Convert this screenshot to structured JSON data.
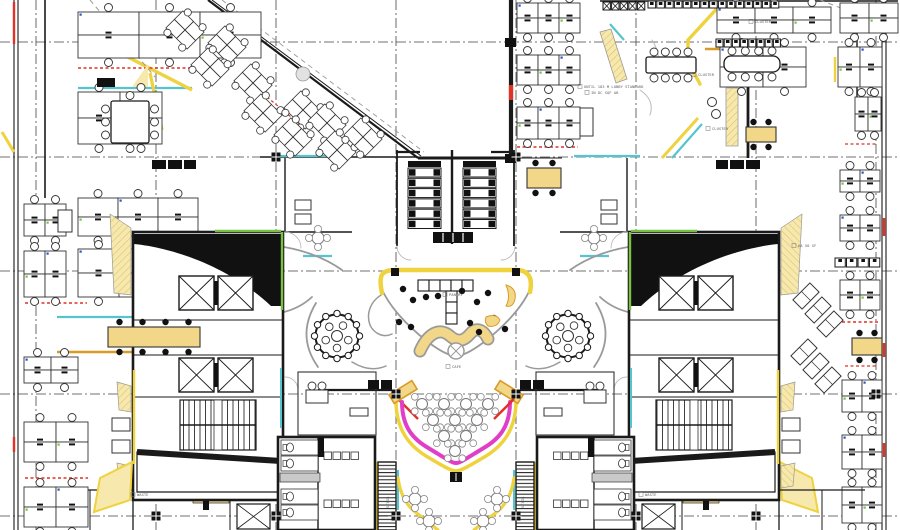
{
  "document": {
    "type": "architectural-floor-plan",
    "description": "office floor plan with two cores, central pantry atrium and cafe"
  },
  "palette": {
    "ink": "#1a1a1a",
    "line": "#333333",
    "gray": "#9a9a9a",
    "lgray": "#bbbbbb",
    "yellow": "#eed23e",
    "paleYellow": "#f7e8ad",
    "tan": "#f2d788",
    "gold": "#d99b26",
    "teal": "#56c4cf",
    "green": "#79c143",
    "magenta": "#e13ec8",
    "red": "#e03226",
    "blue": "#2b53c4"
  },
  "grid": {
    "v": [
      36,
      156,
      276,
      396,
      516,
      636,
      756,
      876
    ],
    "h": [
      42,
      157,
      271,
      394,
      516
    ],
    "markers": [
      [
        276,
        157
      ],
      [
        516,
        157
      ],
      [
        396,
        394
      ],
      [
        516,
        394
      ],
      [
        156,
        516
      ],
      [
        276,
        516
      ],
      [
        396,
        516
      ],
      [
        516,
        516
      ],
      [
        636,
        516
      ],
      [
        756,
        516
      ],
      [
        876,
        394
      ]
    ]
  },
  "annotations": [
    {
      "x": 584,
      "y": 88,
      "text": "UNTIL 183 M LOBBY STANDARD",
      "r": 0
    },
    {
      "x": 591,
      "y": 94,
      "text": "IN DC SQF AB",
      "r": 0
    },
    {
      "x": 755,
      "y": 23,
      "text": "CLUSTER",
      "r": 0
    },
    {
      "x": 698,
      "y": 76,
      "text": "CLUSTER",
      "r": 0
    },
    {
      "x": 712,
      "y": 130,
      "text": "CLUSTER",
      "r": 0
    },
    {
      "x": 449,
      "y": 296,
      "text": "PANTRY",
      "r": 0
    },
    {
      "x": 452,
      "y": 368,
      "text": "CAFE",
      "r": 0
    },
    {
      "x": 137,
      "y": 496,
      "text": "WASTE",
      "r": 0
    },
    {
      "x": 645,
      "y": 496,
      "text": "WASTE",
      "r": 0
    },
    {
      "x": 798,
      "y": 247,
      "text": "6A 50 SF",
      "r": 0
    },
    {
      "x": 389,
      "y": 508,
      "text": "STAIR",
      "r": -90
    },
    {
      "x": 524,
      "y": 508,
      "text": "STAIR",
      "r": -90
    }
  ],
  "clusters": [
    [
      78,
      12,
      3,
      2,
      61,
      23
    ],
    [
      78,
      92,
      2,
      2,
      42,
      26
    ],
    [
      78,
      198,
      3,
      2,
      40,
      19
    ],
    [
      78,
      249,
      3,
      2,
      41,
      24
    ],
    [
      24,
      204,
      2,
      2,
      21,
      16
    ],
    [
      24,
      251,
      2,
      2,
      21,
      23
    ],
    [
      24,
      357,
      2,
      2,
      27,
      13
    ],
    [
      24,
      422,
      2,
      2,
      32,
      20
    ],
    [
      24,
      487,
      2,
      2,
      32,
      20
    ],
    [
      517,
      3,
      3,
      2,
      21,
      15
    ],
    [
      517,
      55,
      3,
      2,
      21,
      15
    ],
    [
      517,
      107,
      3,
      2,
      21,
      16
    ],
    [
      717,
      7,
      3,
      2,
      38,
      13
    ],
    [
      840,
      3,
      2,
      2,
      29,
      15
    ],
    [
      838,
      47,
      2,
      2,
      22,
      20
    ],
    [
      720,
      47,
      2,
      2,
      43,
      20
    ],
    [
      855,
      97,
      2,
      2,
      13,
      17
    ],
    [
      840,
      170,
      2,
      2,
      20,
      11
    ],
    [
      840,
      215,
      2,
      2,
      20,
      13
    ],
    [
      840,
      280,
      2,
      2,
      20,
      15
    ],
    [
      842,
      380,
      2,
      2,
      20,
      16
    ],
    [
      842,
      435,
      2,
      2,
      20,
      17
    ],
    [
      842,
      487,
      2,
      2,
      20,
      18
    ]
  ],
  "cabinets": [
    [
      58,
      210,
      14,
      22
    ],
    [
      580,
      108,
      13,
      28
    ]
  ],
  "rot_clusters": {
    "deg": 45,
    "cw": 15,
    "ch": 12,
    "centers": [
      [
        185,
        30
      ],
      [
        227,
        45
      ],
      [
        210,
        67
      ],
      [
        253,
        83
      ],
      [
        263,
        113
      ],
      [
        303,
        110
      ],
      [
        293,
        137
      ],
      [
        327,
        123
      ],
      [
        337,
        150
      ],
      [
        363,
        137
      ]
    ]
  },
  "banks": {
    "xs": [
      408,
      463
    ],
    "y": 161,
    "w": 33,
    "rows": 6,
    "row_h": 10.3,
    "bench": [
      433,
      232,
      40,
      11
    ]
  },
  "core": {
    "x": 133,
    "y": 232,
    "w": 150,
    "h": 268
  },
  "restroom": {
    "x": 278,
    "y": 437,
    "w": 97,
    "h": 93
  },
  "stair_strip": {
    "x": 378,
    "y": 462,
    "w": 18,
    "h": 68
  },
  "pods": {
    "centers": [
      [
        337,
        336
      ],
      [
        568,
        336
      ]
    ],
    "r": 21.5
  },
  "atrium": {
    "blob": "M396,270 L516,270 C530,270 534,279 531,287 C524,305 506,325 484,342 C472,351 462,356 456,356 C450,356 440,351 428,342 C406,325 388,305 381,287 C378,279 382,270 396,270 Z",
    "wing": "M381,295 C370,302 366,314 370,325 C374,334 384,338 392,334",
    "yellow_band": "M382,293 C378,274 382,270 396,270 L516,270 C528,270 533,277 530,292",
    "posts": [
      [
        391,
        268
      ],
      [
        512,
        268
      ]
    ],
    "cross_row": {
      "x": 418,
      "y": 280,
      "n": 5,
      "s": 11
    },
    "cross_col": {
      "x": 446,
      "y": 291,
      "n": 3,
      "s": 11
    },
    "wave": "M420,351 C428,333 440,327 450,336 C457,342 463,342 470,334 C476,327 483,329 488,339",
    "xcircle": [
      456,
      351,
      8
    ],
    "banana": "M506,285 q11,3 9,14 q-2,9 -9,7 q5,-9 0,-21 Z",
    "leaf": "M486,317 q10,-4 14,3 q-3,8 -12,6 q-4,-4 -2,-9 Z",
    "stools": [
      [
        403,
        289
      ],
      [
        413,
        300
      ],
      [
        426,
        297
      ],
      [
        438,
        296
      ],
      [
        462,
        291
      ],
      [
        477,
        302
      ],
      [
        488,
        293
      ],
      [
        399,
        322
      ],
      [
        411,
        327
      ],
      [
        470,
        323
      ],
      [
        479,
        332
      ],
      [
        494,
        318
      ],
      [
        505,
        329
      ]
    ]
  },
  "cafe": {
    "pink": "M402,402 C402,428 414,440 430,449 C448,460 452,463 456,463 C460,463 464,460 482,449 C498,440 510,428 510,402",
    "yellow": "M396,397 C395,430 410,446 426,456 C446,468 452,471 456,471 C460,471 466,468 486,456 C502,446 517,430 516,397",
    "rows": [
      {
        "y": 404,
        "xs": [
          422,
          444,
          466,
          488
        ]
      },
      {
        "y": 420,
        "xs": [
          433,
          455,
          477
        ]
      },
      {
        "y": 436,
        "xs": [
          444,
          466
        ]
      },
      {
        "y": 451,
        "xs": [
          455
        ]
      }
    ],
    "black_sq": [
      450,
      472,
      12,
      10
    ],
    "counter": {
      "cx": 403,
      "cy": 392,
      "w": 27,
      "h": 10,
      "rot": -32
    }
  },
  "petal_tables": [
    [
      318,
      238
    ],
    [
      415,
      499
    ],
    [
      429,
      521
    ]
  ],
  "tables_white": [
    {
      "x": 111,
      "y": 101,
      "w": 38,
      "h": 42,
      "dir": "v"
    },
    {
      "x": 646,
      "y": 57,
      "w": 50,
      "h": 16,
      "dir": "h"
    },
    {
      "x": 724,
      "y": 56,
      "w": 56,
      "h": 16,
      "dir": "h",
      "rx": 7
    }
  ],
  "tables_yellow": [
    [
      108,
      327,
      92,
      20
    ],
    [
      527,
      168,
      34,
      20
    ],
    [
      852,
      338,
      30,
      17
    ],
    [
      746,
      127,
      30,
      15
    ]
  ],
  "sq_rows": [
    {
      "x": 648,
      "y": 1,
      "n": 15,
      "s": 8.8,
      "h": 7,
      "tick": 1
    },
    {
      "x": 603,
      "y": 2,
      "n": 5,
      "s": 8.6,
      "h": 8,
      "xmark": 1
    },
    {
      "x": 716,
      "y": 39,
      "n": 8,
      "s": 8.2,
      "h": 8,
      "tick": 1
    },
    {
      "x": 835,
      "y": 258,
      "n": 4,
      "s": 11.5,
      "h": 9,
      "tick": 1
    }
  ],
  "rot_lockers": {
    "w": 13,
    "h": 24,
    "deg": 45,
    "centers": [
      [
        806,
        296
      ],
      [
        818,
        310
      ],
      [
        830,
        324
      ],
      [
        804,
        352
      ],
      [
        816,
        366
      ],
      [
        828,
        380
      ]
    ]
  },
  "xboxes": [
    [
      237,
      504,
      33,
      25,
      1
    ]
  ],
  "black_boxes": [
    [
      368,
      380,
      11,
      9,
      1
    ],
    [
      381,
      380,
      11,
      9,
      1
    ],
    [
      505,
      38,
      11,
      9,
      0
    ],
    [
      505,
      154,
      11,
      9,
      0
    ],
    [
      97,
      78,
      18,
      9,
      0
    ],
    [
      152,
      160,
      14,
      9,
      1
    ],
    [
      168,
      160,
      14,
      9,
      1
    ],
    [
      184,
      160,
      12,
      9,
      1
    ],
    [
      203,
      501,
      6,
      9,
      1
    ]
  ],
  "sofas": [
    [
      112,
      418,
      18,
      13,
      1
    ],
    [
      112,
      440,
      18,
      13,
      1
    ],
    [
      350,
      408,
      18,
      8,
      1
    ],
    [
      306,
      390,
      22,
      13,
      1
    ],
    [
      295,
      200,
      16,
      10,
      1
    ],
    [
      295,
      214,
      16,
      10,
      1
    ]
  ],
  "tree": [
    303,
    74,
    7
  ],
  "lines": [
    [
      14,
      0,
      14,
      530,
      1.1,
      "ink",
      0,
      0
    ],
    [
      18,
      0,
      18,
      530,
      1.1,
      "ink",
      0,
      0
    ],
    [
      45,
      0,
      45,
      198,
      1.6,
      "ink",
      0,
      0
    ],
    [
      882,
      0,
      882,
      530,
      1.1,
      "ink",
      0,
      0
    ],
    [
      886,
      0,
      886,
      530,
      1.1,
      "ink",
      0,
      0
    ],
    [
      857,
      0,
      857,
      130,
      1.4,
      "ink",
      0,
      0
    ],
    [
      600,
      1,
      898,
      1,
      1.4,
      "ink",
      0,
      0
    ],
    [
      208,
      0,
      418,
      158,
      2.2,
      "ink",
      0,
      0
    ],
    [
      212,
      0,
      421,
      156,
      1,
      "ink",
      0,
      0
    ],
    [
      511,
      0,
      511,
      158,
      4.2,
      "ink",
      0,
      0
    ],
    [
      418,
      158,
      511,
      158,
      3,
      "ink",
      0,
      0
    ],
    [
      260,
      157,
      418,
      157,
      1.4,
      "ink",
      0,
      0
    ],
    [
      506,
      158,
      562,
      158,
      1.1,
      "ink",
      0,
      0
    ],
    [
      397,
      150,
      397,
      246,
      1.8,
      "ink",
      0,
      0
    ],
    [
      514,
      150,
      514,
      246,
      1.8,
      "ink",
      0,
      0
    ],
    [
      397,
      152,
      420,
      152,
      2.2,
      "ink",
      0,
      0
    ],
    [
      491,
      152,
      514,
      152,
      2.2,
      "ink",
      0,
      0
    ],
    [
      452,
      150,
      452,
      244,
      2.4,
      "ink",
      0,
      0
    ],
    [
      318,
      390,
      392,
      390,
      2.2,
      "ink",
      0,
      0
    ],
    [
      520,
      390,
      598,
      390,
      2.2,
      "ink",
      0,
      0
    ],
    [
      285,
      158,
      285,
      232,
      1.4,
      "ink",
      1,
      0
    ],
    [
      285,
      232,
      352,
      232,
      1.4,
      "ink",
      1,
      0
    ],
    [
      47,
      490,
      283,
      490,
      1.2,
      "ink",
      1,
      0
    ],
    [
      90,
      490,
      90,
      530,
      1,
      "ink",
      1,
      0
    ],
    [
      133,
      490,
      133,
      530,
      1.3,
      "ink",
      1,
      0
    ],
    [
      230,
      490,
      230,
      530,
      1,
      "ink",
      1,
      0
    ],
    [
      272,
      156,
      338,
      156,
      2.2,
      "teal",
      1,
      0
    ],
    [
      303,
      256,
      332,
      256,
      2.2,
      "teal",
      1,
      0
    ],
    [
      78,
      88,
      192,
      88,
      2.2,
      "teal",
      0,
      0
    ],
    [
      57,
      317,
      215,
      317,
      2.2,
      "teal",
      0,
      0
    ],
    [
      57,
      352,
      222,
      352,
      2.4,
      "gold",
      0,
      0
    ],
    [
      118,
      52,
      192,
      90,
      3.4,
      "yellow",
      0,
      0
    ],
    [
      150,
      73,
      162,
      130,
      3.2,
      "yellow",
      0,
      0
    ],
    [
      154,
      108,
      154,
      130,
      2,
      "teal",
      0,
      0
    ],
    [
      215,
      317,
      230,
      345,
      3,
      "yellow",
      0,
      0
    ],
    [
      2,
      132,
      14,
      152,
      3,
      "yellow",
      0,
      0
    ],
    [
      705,
      49,
      788,
      49,
      2.4,
      "gold",
      0,
      0
    ],
    [
      728,
      86,
      790,
      86,
      2.2,
      "teal",
      0,
      0
    ],
    [
      610,
      24,
      624,
      40,
      2.2,
      "teal",
      0,
      0
    ],
    [
      748,
      85,
      748,
      158,
      2.8,
      "ink",
      0,
      0
    ],
    [
      698,
      118,
      662,
      158,
      3,
      "yellow",
      0,
      0
    ],
    [
      702,
      124,
      672,
      158,
      2.2,
      "teal",
      0,
      0
    ],
    [
      835,
      57,
      835,
      82,
      2.4,
      "yellow",
      0,
      0
    ],
    [
      726,
      117,
      738,
      117,
      1,
      "line",
      0,
      0
    ],
    [
      376,
      462,
      376,
      530,
      3,
      "yellow",
      1,
      0
    ],
    [
      398,
      470,
      398,
      510,
      2,
      "teal",
      1,
      0
    ],
    [
      193,
      491,
      228,
      491,
      2.2,
      "green",
      1,
      0
    ],
    [
      396,
      273,
      516,
      273,
      1.2,
      "gold",
      0,
      0
    ],
    [
      90,
      0,
      155,
      77,
      1,
      "gray",
      0,
      "d3"
    ],
    [
      820,
      0,
      898,
      30,
      1,
      "gray",
      0,
      "d3"
    ],
    [
      222,
      0,
      424,
      152,
      0.9,
      "gray",
      0,
      "d3"
    ],
    [
      78,
      68,
      200,
      68,
      1.4,
      "red",
      0,
      "d1"
    ],
    [
      25,
      303,
      87,
      303,
      1.4,
      "red",
      0,
      "d1"
    ],
    [
      517,
      147,
      578,
      147,
      1.4,
      "red",
      0,
      "d1"
    ],
    [
      842,
      322,
      880,
      322,
      1.4,
      "red",
      0,
      "d1"
    ],
    [
      845,
      366,
      877,
      366,
      1.2,
      "red",
      0,
      "d1"
    ],
    [
      845,
      144,
      877,
      144,
      1.2,
      "red",
      0,
      "d1"
    ],
    [
      25,
      478,
      88,
      478,
      1.4,
      "red",
      0,
      "d1"
    ],
    [
      267,
      97,
      303,
      127,
      1.2,
      "red",
      0,
      "d1"
    ],
    [
      511,
      85,
      511,
      100,
      4.2,
      "red",
      0,
      0
    ],
    [
      884,
      218,
      884,
      236,
      2.4,
      "red",
      0,
      0
    ],
    [
      884,
      343,
      884,
      357,
      2.4,
      "red",
      0,
      0
    ],
    [
      884,
      443,
      884,
      457,
      2.4,
      "red",
      0,
      0
    ],
    [
      14,
      2,
      14,
      44,
      2.4,
      "red",
      0,
      0
    ],
    [
      14,
      437,
      14,
      452,
      2.4,
      "red",
      0,
      0
    ],
    [
      398,
      399,
      418,
      419,
      2.4,
      "red",
      1,
      0
    ],
    [
      153,
      115,
      153,
      124,
      2,
      "blue",
      0,
      0
    ],
    [
      750,
      52,
      750,
      76,
      4.5,
      "blue",
      0,
      0
    ],
    [
      278,
      529,
      375,
      529,
      2.5,
      "ink",
      1,
      0
    ]
  ],
  "polys": [
    {
      "pts": [
        [
          600,
          32
        ],
        [
          611,
          29
        ],
        [
          627,
          79
        ],
        [
          616,
          83
        ]
      ],
      "f": "paleYellow",
      "s": "gray",
      "w": 0.8,
      "h": 1,
      "m": 0
    },
    {
      "pts": [
        [
          132,
          87
        ],
        [
          148,
          87
        ],
        [
          148,
          64
        ]
      ],
      "f": "paleYellow",
      "s": "none",
      "w": 0,
      "h": 0,
      "m": 0
    },
    {
      "pts": [
        [
          726,
          88
        ],
        [
          738,
          88
        ],
        [
          738,
          146
        ],
        [
          726,
          146
        ]
      ],
      "f": "paleYellow",
      "s": "gray",
      "w": 0.8,
      "h": 1,
      "m": 0
    },
    {
      "pts": [
        [
          780,
          462
        ],
        [
          812,
          478
        ],
        [
          818,
          512
        ],
        [
          782,
          500
        ]
      ],
      "f": "paleYellow",
      "s": "yellow",
      "w": 2,
      "h": 0,
      "m": 1
    },
    {
      "pts": [
        [
          193,
          493
        ],
        [
          229,
          493
        ],
        [
          229,
          503
        ],
        [
          193,
          503
        ]
      ],
      "f": "tan",
      "s": "line",
      "w": 0.7,
      "h": 0,
      "m": 1
    }
  ],
  "paths": [
    {
      "d": "M284,247 Q318,253 342,270",
      "s": "gray",
      "w": 1.8,
      "f": "none",
      "m": 1
    },
    {
      "d": "M284,312 Q300,308 312,297",
      "s": "gray",
      "w": 1.8,
      "f": "none",
      "m": 1
    },
    {
      "d": "M316,303 Q296,336 318,367",
      "s": "gray",
      "w": 1.8,
      "f": "none",
      "m": 1
    },
    {
      "d": "M352,362 Q370,373 386,366",
      "s": "gray",
      "w": 1.5,
      "f": "none",
      "m": 1
    },
    {
      "d": "M398,478 Q401,500 414,511 Q428,522 438,530",
      "s": "yellow",
      "w": 3.2,
      "f": "none",
      "m": 1
    },
    {
      "d": "M722,3 L688,40 L688,62 L700,84",
      "s": "yellow",
      "w": 3.4,
      "f": "none",
      "m": 0
    },
    {
      "d": "M652,40 Q664,58 654,78",
      "s": "lgray",
      "w": 1,
      "f": "none",
      "m": 0
    },
    {
      "d": "M640,90 Q655,100 650,115",
      "s": "lgray",
      "w": 1,
      "f": "none",
      "m": 0
    },
    {
      "d": "M397,246 a14 14 0 0 0 14 14",
      "s": "lgray",
      "w": 0.9,
      "f": "none",
      "m": 1
    },
    {
      "d": "M285,232 a16 16 0 0 1 16 16",
      "s": "lgray",
      "w": 0.9,
      "f": "none",
      "m": 1
    },
    {
      "d": "M285,377 a13 13 0 0 1 13 13",
      "s": "lgray",
      "w": 0.9,
      "f": "none",
      "m": 1
    },
    {
      "d": "M358,437 a12 12 0 0 0 -12 12",
      "s": "lgray",
      "w": 0.9,
      "f": "none",
      "m": 1
    }
  ],
  "phone_chairs": [
    [
      712,
      102
    ],
    [
      716,
      114
    ]
  ]
}
